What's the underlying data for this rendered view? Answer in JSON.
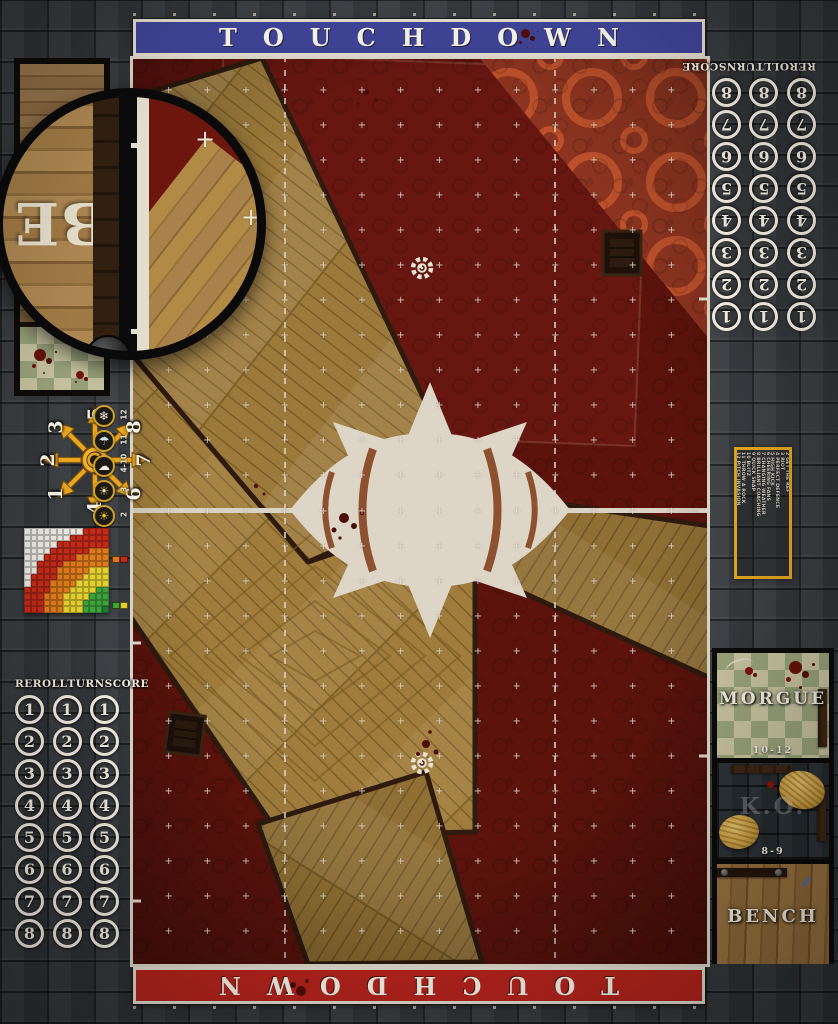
{
  "banners": {
    "top_label": "TOUCHDOWN",
    "bottom_label": "TOUCHDOWN",
    "top_color": "#3e4293",
    "bottom_color": "#b1231c"
  },
  "turn_tracks": {
    "header": [
      "REROLL",
      "TURN",
      "SCORE"
    ],
    "numbers": [
      "1",
      "2",
      "3",
      "4",
      "5",
      "6",
      "7",
      "8"
    ],
    "columns": 3
  },
  "scatter_template": {
    "numbers": [
      {
        "label": "1",
        "dir": "sw"
      },
      {
        "label": "2",
        "dir": "w"
      },
      {
        "label": "3",
        "dir": "nw"
      },
      {
        "label": "4",
        "dir": "s"
      },
      {
        "label": "5",
        "dir": "n"
      },
      {
        "label": "6",
        "dir": "se"
      },
      {
        "label": "7",
        "dir": "e"
      },
      {
        "label": "8",
        "dir": "ne"
      }
    ]
  },
  "weather_table": {
    "rows": [
      {
        "value": "12",
        "icon": "snow-icon"
      },
      {
        "value": "11",
        "icon": "rain-icon"
      },
      {
        "value": "4-10",
        "icon": "cloud-sun-icon"
      },
      {
        "value": "3",
        "icon": "hazy-sun-icon"
      },
      {
        "value": "2",
        "icon": "sun-icon"
      }
    ],
    "glyphs": {
      "snow-icon": "❄",
      "rain-icon": "☂",
      "cloud-sun-icon": "☁",
      "hazy-sun-icon": "☀",
      "sun-icon": "☀"
    }
  },
  "kickoff_table": {
    "rows": [
      "2 GET THE REF",
      "3 RIOT",
      "4 PERFECT DEFENCE",
      "5 HIGH KICK",
      "6 CHEERING FANS",
      "7 CHANGING WEATHER",
      "8 BRILLIANT COACHING",
      "9 QUICK SNAP",
      "10 BLITZ",
      "11 THROW A ROCK",
      "12 PITCH INVASION"
    ]
  },
  "range_ruler": {
    "cols": 13,
    "rows": 13,
    "origin": "bottom-right",
    "bands": [
      {
        "name": "quick-pass",
        "color": "#3da23c",
        "max": 3.4
      },
      {
        "name": "short-pass",
        "color": "#e3cf2e",
        "max": 6.4
      },
      {
        "name": "long-pass",
        "color": "#dd7a1a",
        "max": 9.4
      },
      {
        "name": "long-bomb",
        "color": "#c22a18",
        "max": 12.4
      },
      {
        "name": "out-of-range",
        "color": "#e9e7df",
        "max": 99
      }
    ],
    "corner_color": "#1f7a2e",
    "legend_pairs": [
      [
        "#dd7a1a",
        "#c22a18"
      ],
      [
        "#3da23c",
        "#e3cf2e"
      ]
    ]
  },
  "dugout": {
    "morgue_label": "MORGUE",
    "morgue_range": "10-12",
    "ko_label": "K.O.",
    "ko_range": "8-9",
    "bench_label": "BENCH"
  },
  "magnifier": {
    "letters": "BE"
  },
  "pitch": {
    "grid_cols": 15,
    "grid_rows": 26,
    "accent_line": "#ded8ca",
    "carpet": "#5d140d",
    "wood": "#9b7839"
  }
}
